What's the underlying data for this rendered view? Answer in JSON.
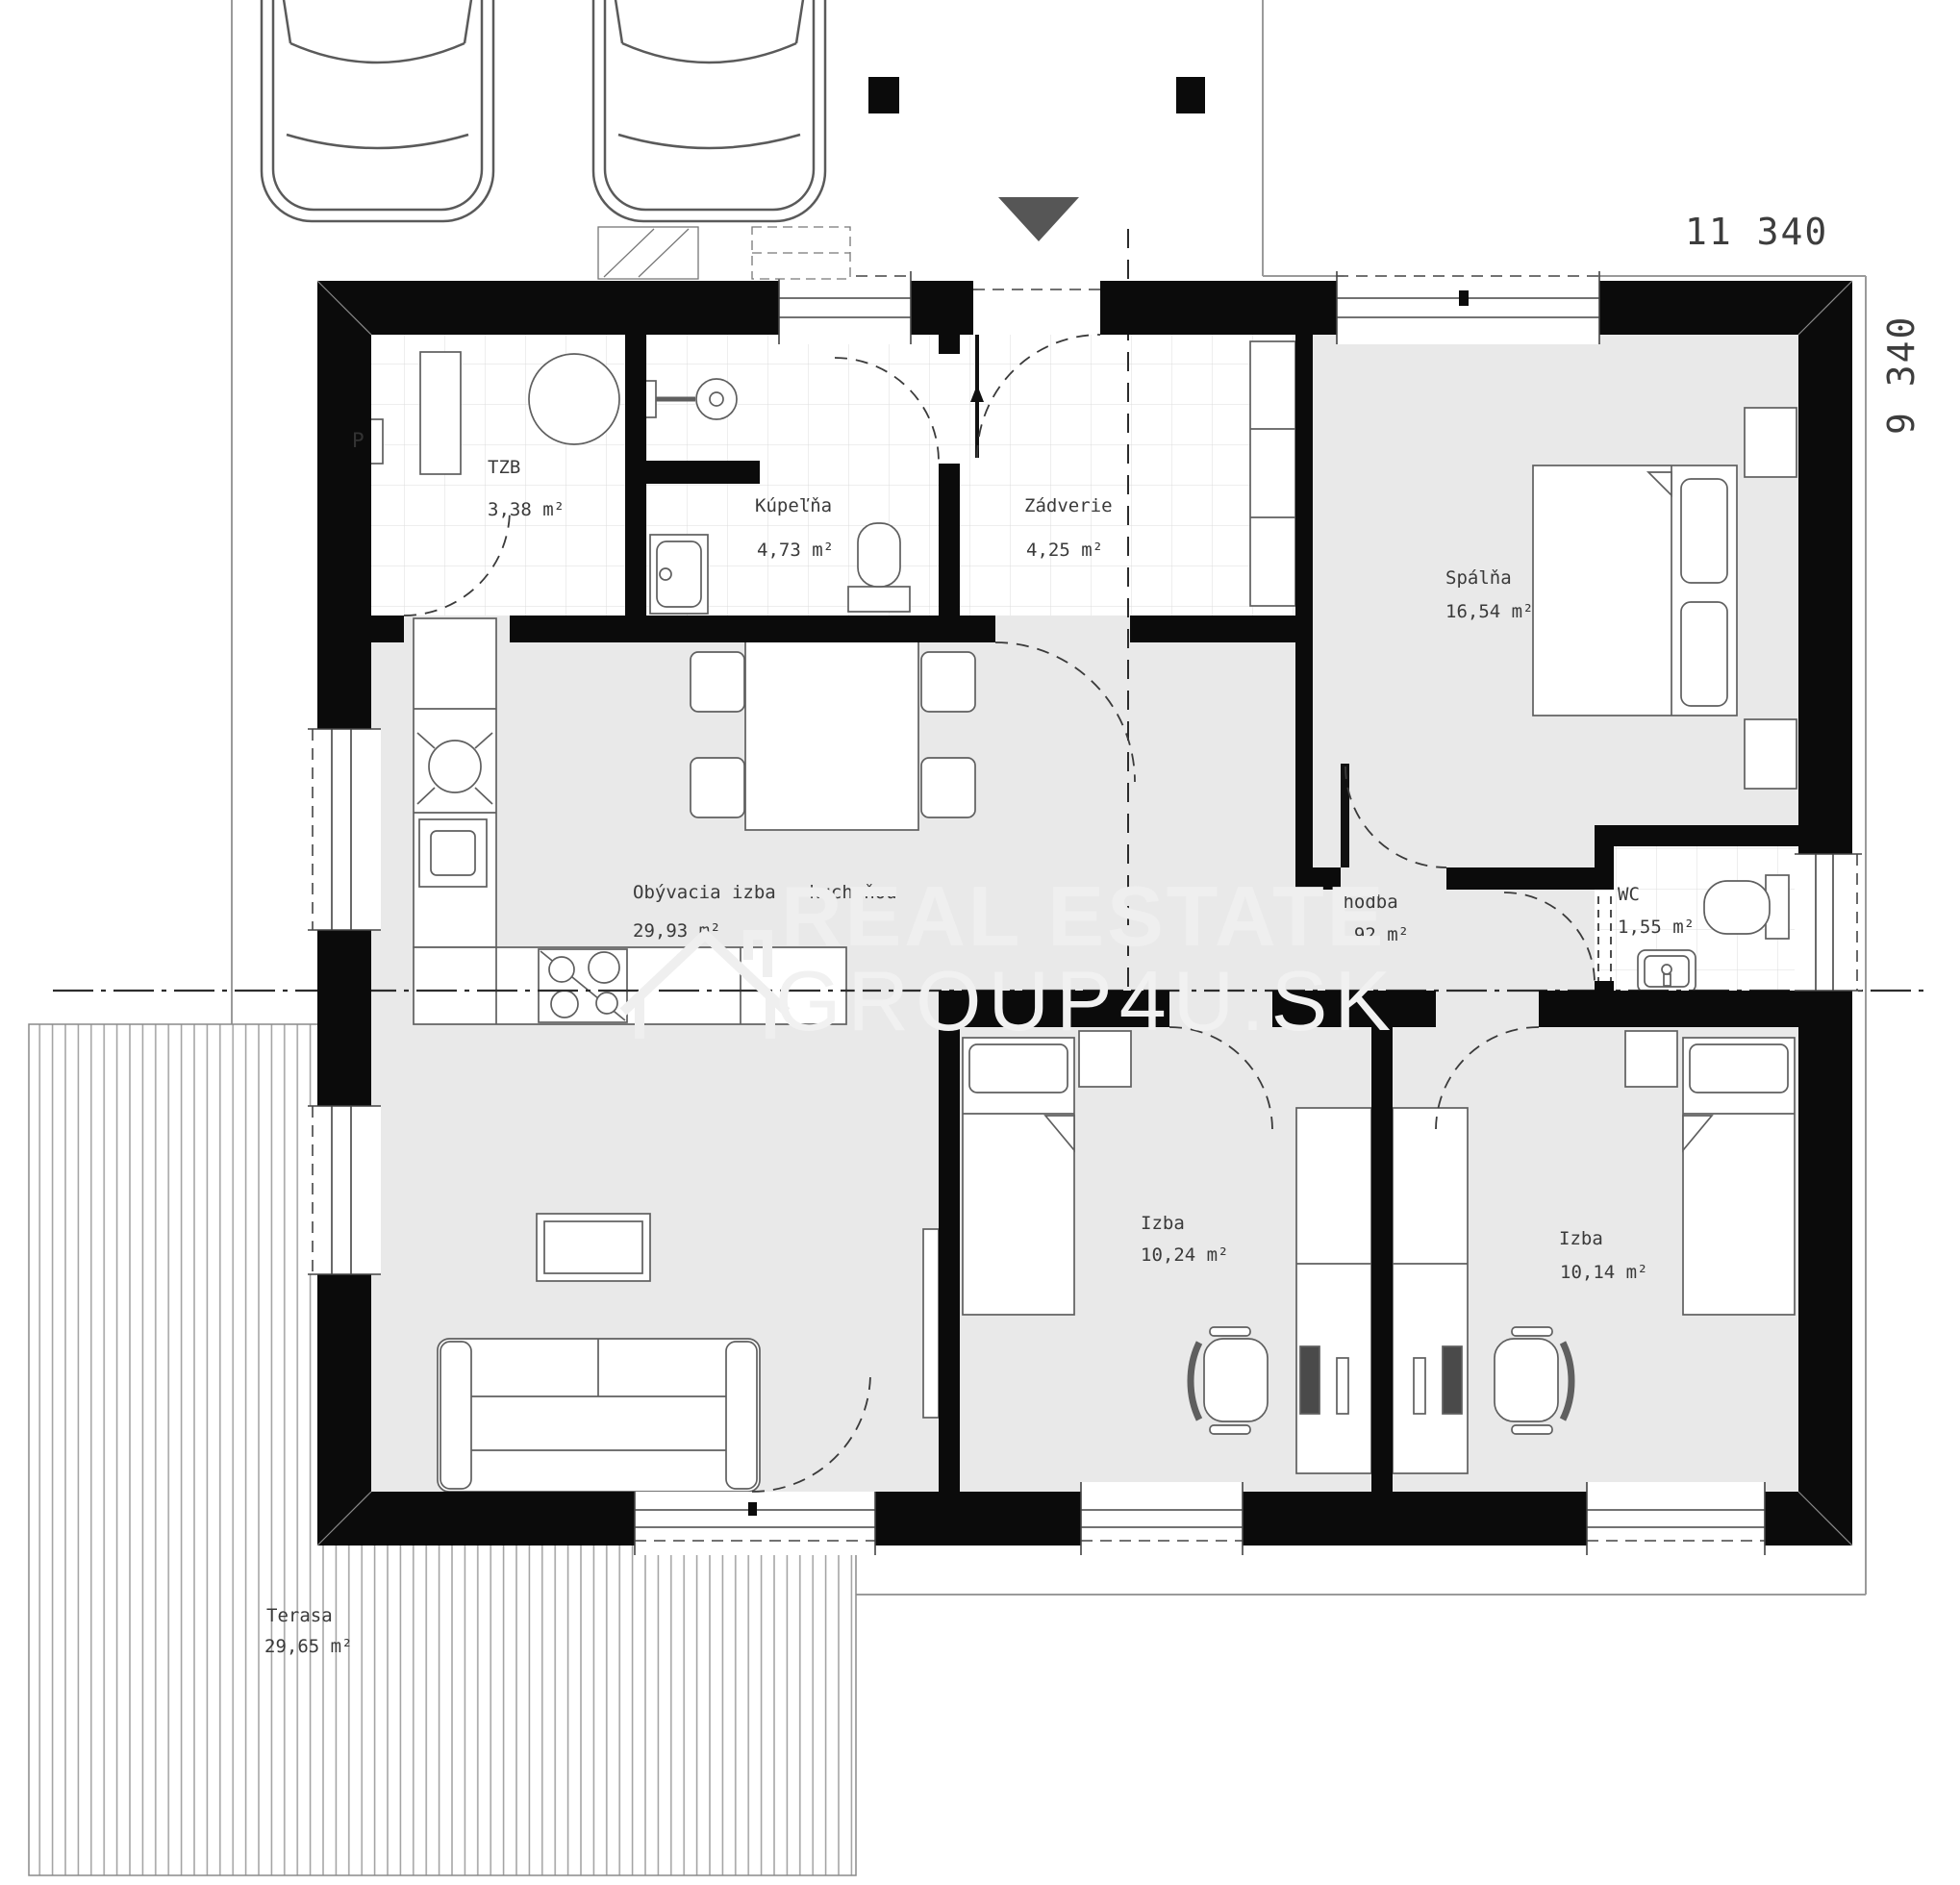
{
  "rooms": [
    {
      "id": "tzb",
      "name": "TZB",
      "area": "3,38 m²"
    },
    {
      "id": "kupelna",
      "name": "Kúpeľňa",
      "area": "4,73 m²"
    },
    {
      "id": "zadverie",
      "name": "Zádverie",
      "area": "4,25 m²"
    },
    {
      "id": "spalna",
      "name": "Spálňa",
      "area": "16,54 m²"
    },
    {
      "id": "obyvacia",
      "name": "Obývacia izba s kuchyňou",
      "area": "29,93 m²"
    },
    {
      "id": "chodba",
      "name": "Chodba",
      "area": "3,92 m²"
    },
    {
      "id": "wc",
      "name": "WC",
      "area": "1,55 m²"
    },
    {
      "id": "izba1",
      "name": "Izba",
      "area": "10,24 m²"
    },
    {
      "id": "izba2",
      "name": "Izba",
      "area": "10,14 m²"
    },
    {
      "id": "terasa",
      "name": "Terasa",
      "area": "29,65 m²"
    }
  ],
  "dimensions": {
    "width": "11 340",
    "height": "9 340"
  },
  "watermark": {
    "line1": "REAL ESTATE",
    "line2": "GROUP4U.SK"
  },
  "appliances": {
    "washing_machine": "P"
  },
  "colors": {
    "wall": "#0b0b0b",
    "floor": "#e9e9e9",
    "tile_line": "#dcdcdc",
    "deck_line": "#a0a0a0",
    "outline": "#5f5f5f",
    "triangle": "#565656",
    "watermark": "#efefef",
    "label": "#3a3a3a"
  }
}
